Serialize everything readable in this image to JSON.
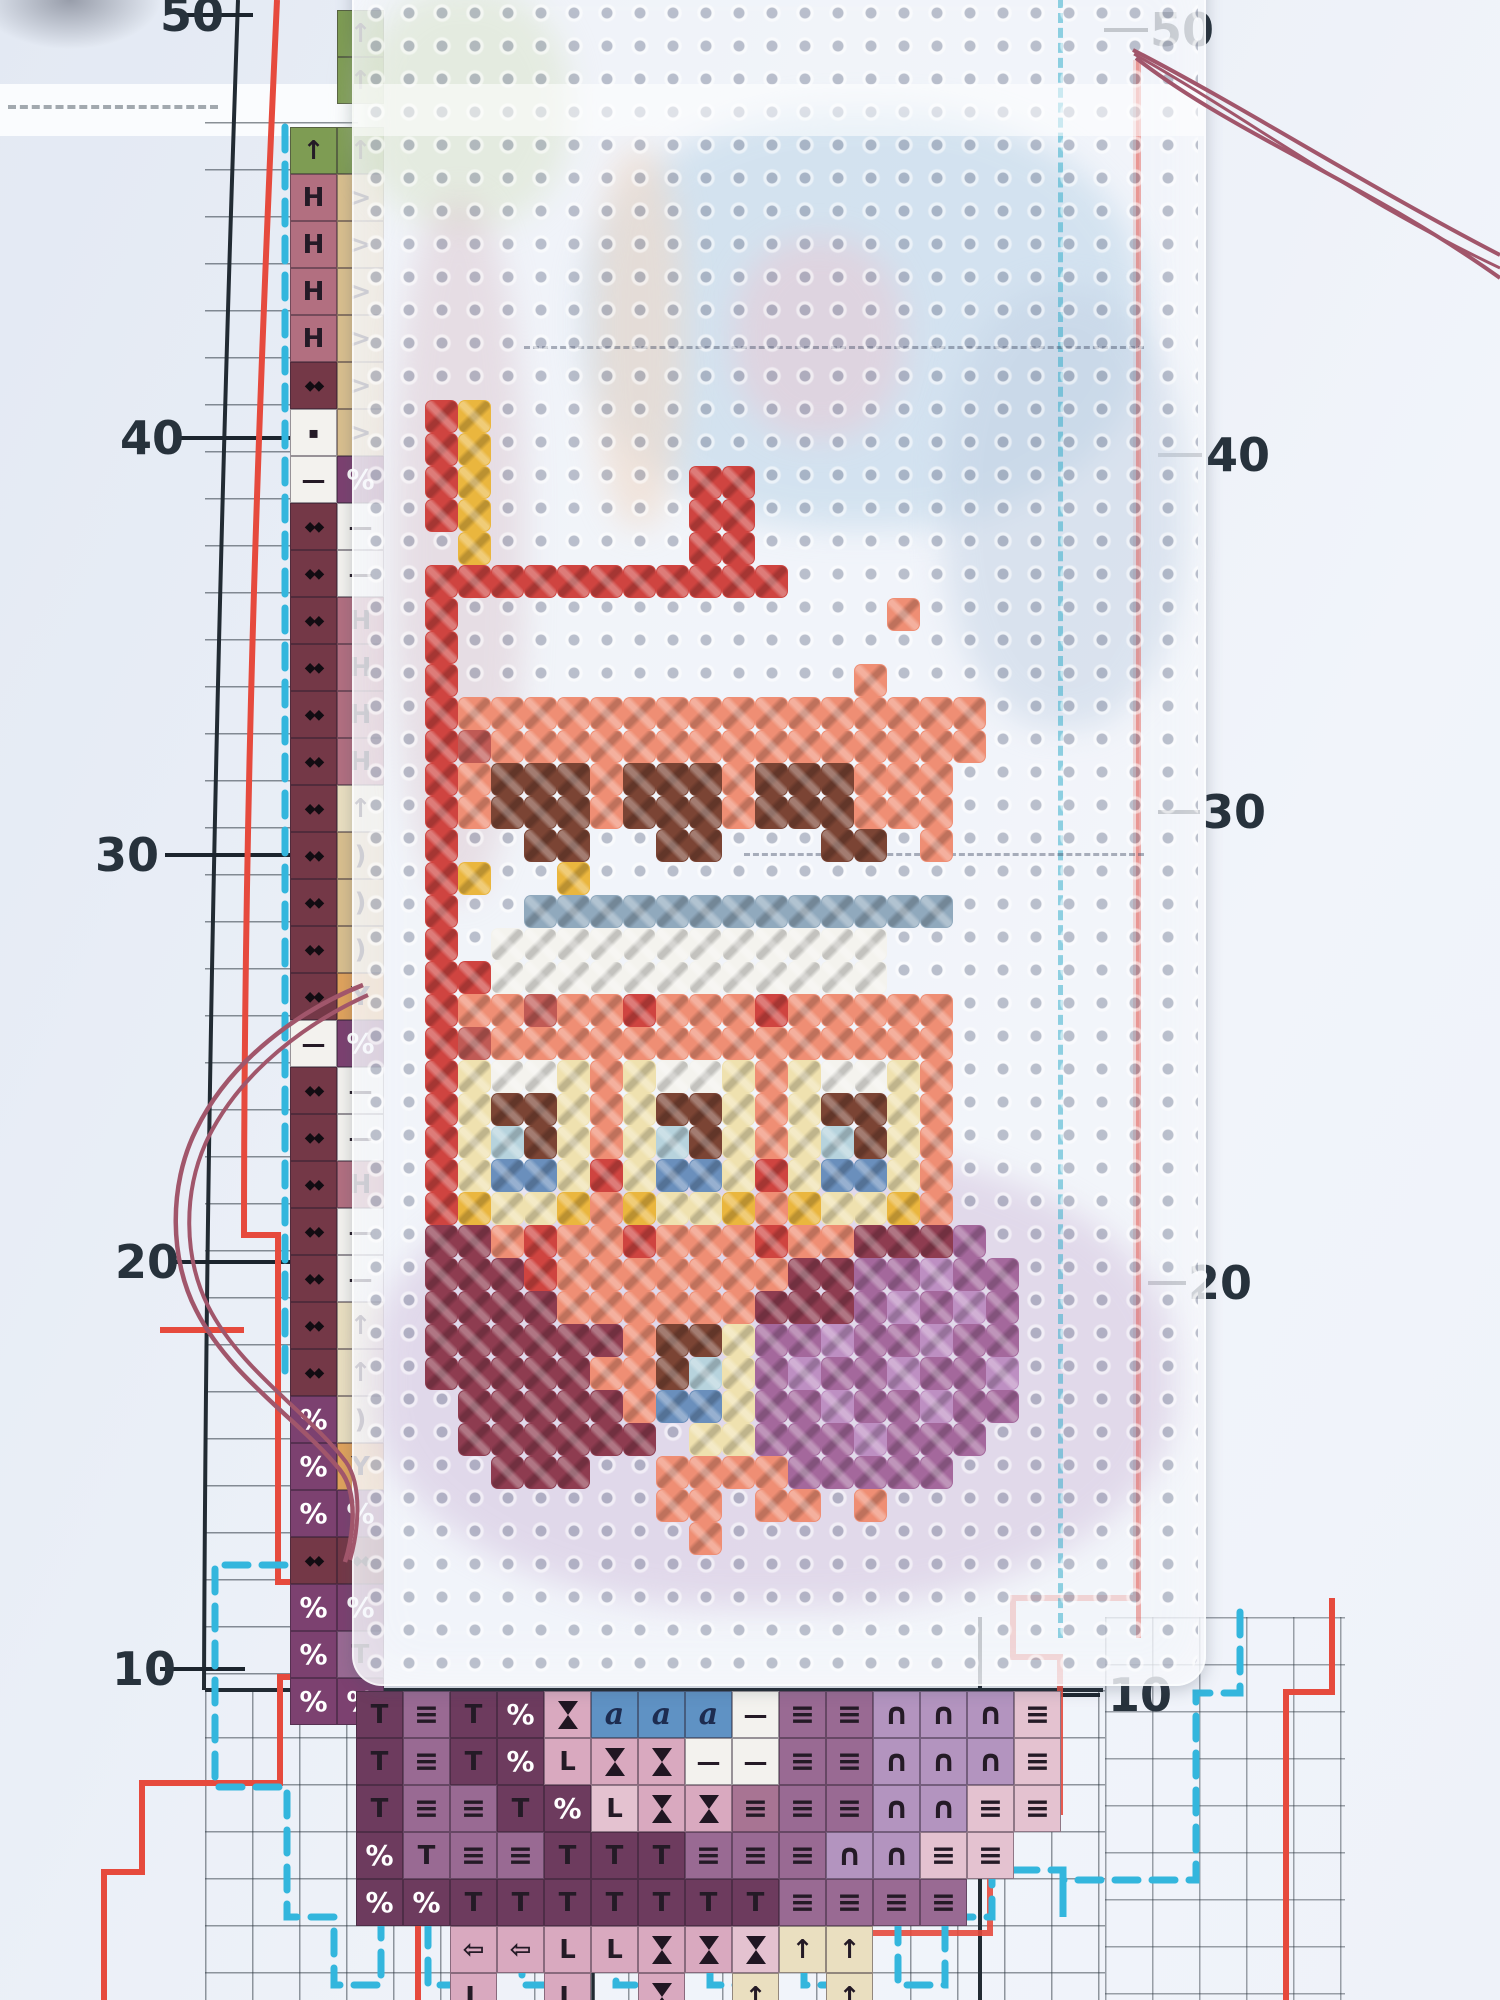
{
  "scene_type": "photo of cross-stitch embroidery in progress on perforated plastic canvas over a printed counted-stitch chart",
  "chart": {
    "row_labels": [
      {
        "value": "50",
        "left": {
          "x": 160,
          "y": 15,
          "tick": [
            180,
            253
          ]
        },
        "right": {
          "x": 1150,
          "y": 30,
          "tick": [
            1104,
            1148
          ]
        }
      },
      {
        "value": "40",
        "left": {
          "x": 120,
          "y": 438,
          "tick": [
            180,
            358
          ]
        },
        "right": {
          "x": 1206,
          "y": 455,
          "tick": [
            1158,
            1202
          ]
        }
      },
      {
        "value": "30",
        "left": {
          "x": 95,
          "y": 855,
          "tick": [
            165,
            358
          ]
        },
        "right": {
          "x": 1202,
          "y": 812,
          "tick": [
            1158,
            1200
          ]
        }
      },
      {
        "value": "20",
        "left": {
          "x": 115,
          "y": 1262,
          "tick": [
            175,
            358
          ]
        },
        "right": {
          "x": 1188,
          "y": 1283,
          "tick": [
            1148,
            1186
          ]
        }
      },
      {
        "value": "10",
        "left": {
          "x": 112,
          "y": 1669,
          "tick": [
            160,
            245
          ]
        },
        "right": {
          "x": 1108,
          "y": 1695,
          "tick": [
            1040,
            1100
          ]
        }
      }
    ],
    "glyphs": {
      "up": "↑",
      "H": "H",
      "gt": ">",
      "diam": "◆◆",
      "sq": "▪",
      "dash": "—",
      "pct": "%",
      "paren": ")",
      "yy": "Y",
      "T": "T",
      "ident": "≡",
      "cap": "∩",
      "a": "a",
      "L": "L",
      "larr": "⇦",
      "hg": ""
    },
    "cell_palette": {
      "green": "#7e9c53",
      "mauve": "#b26f80",
      "tan": "#d9bf8e",
      "maroon": "#743847",
      "white": "#f3f2ee",
      "purple": "#7c4170",
      "cream": "#eadfc0",
      "orange": "#e0a35c",
      "plumDark": "#6d3b5e",
      "plumMid": "#996a93",
      "pink": "#d9a9bf",
      "pinkLight": "#e4c2d0",
      "lavender": "#b394bf",
      "blue": "#5f92c4",
      "mauveMid": "#a87493"
    },
    "left_strip": {
      "rows": [
        [
          10,
          null,
          [
            "up",
            "green"
          ]
        ],
        [
          57,
          null,
          [
            "up",
            "green"
          ]
        ],
        [
          127,
          [
            "up",
            "green"
          ],
          [
            "up",
            "green"
          ]
        ],
        [
          174,
          [
            "H",
            "mauve"
          ],
          [
            "gt",
            "tan"
          ]
        ],
        [
          221,
          [
            "H",
            "mauve"
          ],
          [
            "gt",
            "tan"
          ]
        ],
        [
          268,
          [
            "H",
            "mauve"
          ],
          [
            "gt",
            "tan"
          ]
        ],
        [
          315,
          [
            "H",
            "mauve"
          ],
          [
            "gt",
            "tan"
          ]
        ],
        [
          362,
          [
            "diam",
            "maroon"
          ],
          [
            "gt",
            "tan"
          ]
        ],
        [
          409,
          [
            "sq",
            "white"
          ],
          [
            "gt",
            "tan"
          ]
        ],
        [
          456,
          [
            "dash",
            "white"
          ],
          [
            "pct",
            "purple"
          ]
        ],
        [
          503,
          [
            "diam",
            "maroon"
          ],
          [
            "dash",
            "white"
          ]
        ],
        [
          550,
          [
            "diam",
            "maroon"
          ],
          [
            "dash",
            "white"
          ]
        ],
        [
          597,
          [
            "diam",
            "maroon"
          ],
          [
            "H",
            "mauve"
          ]
        ],
        [
          644,
          [
            "diam",
            "maroon"
          ],
          [
            "H",
            "mauve"
          ]
        ],
        [
          691,
          [
            "diam",
            "maroon"
          ],
          [
            "H",
            "mauve"
          ]
        ],
        [
          738,
          [
            "diam",
            "maroon"
          ],
          [
            "H",
            "mauve"
          ]
        ],
        [
          785,
          [
            "diam",
            "maroon"
          ],
          [
            "up",
            "cream"
          ]
        ],
        [
          832,
          [
            "diam",
            "maroon"
          ],
          [
            "paren",
            "tan"
          ]
        ],
        [
          879,
          [
            "diam",
            "maroon"
          ],
          [
            "paren",
            "tan"
          ]
        ],
        [
          926,
          [
            "diam",
            "maroon"
          ],
          [
            "paren",
            "tan"
          ]
        ],
        [
          973,
          [
            "diam",
            "maroon"
          ],
          [
            "yy",
            "orange"
          ]
        ],
        [
          1020,
          [
            "dash",
            "white"
          ],
          [
            "pct",
            "purple"
          ]
        ],
        [
          1067,
          [
            "diam",
            "maroon"
          ],
          [
            "dash",
            "white"
          ]
        ],
        [
          1114,
          [
            "diam",
            "maroon"
          ],
          [
            "dash",
            "white"
          ]
        ],
        [
          1161,
          [
            "diam",
            "maroon"
          ],
          [
            "H",
            "mauve"
          ]
        ],
        [
          1208,
          [
            "diam",
            "maroon"
          ],
          [
            "dash",
            "white"
          ]
        ],
        [
          1255,
          [
            "diam",
            "maroon"
          ],
          [
            "dash",
            "white"
          ]
        ],
        [
          1302,
          [
            "diam",
            "maroon"
          ],
          [
            "up",
            "cream"
          ]
        ],
        [
          1349,
          [
            "diam",
            "maroon"
          ],
          [
            "up",
            "cream"
          ]
        ],
        [
          1396,
          [
            "pct",
            "purple"
          ],
          [
            "paren",
            "cream"
          ]
        ],
        [
          1443,
          [
            "pct",
            "purple"
          ],
          [
            "yy",
            "orange"
          ]
        ],
        [
          1490,
          [
            "pct",
            "purple"
          ],
          [
            "pct",
            "purple"
          ]
        ],
        [
          1537,
          [
            "diam",
            "maroon"
          ],
          [
            "diam",
            "maroon"
          ]
        ],
        [
          1584,
          [
            "pct",
            "purple"
          ],
          [
            "pct",
            "purple"
          ]
        ],
        [
          1631,
          [
            "pct",
            "purple"
          ],
          [
            "T",
            "plumMid"
          ]
        ],
        [
          1678,
          [
            "pct",
            "purple"
          ],
          [
            "pct",
            "purple"
          ]
        ]
      ]
    },
    "bottom_block": {
      "origin": [
        356,
        1691
      ],
      "rows": [
        [
          [
            "T",
            "plumDark"
          ],
          [
            "ident",
            "plumMid"
          ],
          [
            "T",
            "plumDark"
          ],
          [
            "pct",
            "plumDark"
          ],
          [
            "hg",
            "pink"
          ],
          [
            "a",
            "blue"
          ],
          [
            "a",
            "blue"
          ],
          [
            "a",
            "blue"
          ],
          [
            "dash",
            "white"
          ],
          [
            "ident",
            "plumMid"
          ],
          [
            "ident",
            "plumMid"
          ],
          [
            "cap",
            "lavender"
          ],
          [
            "cap",
            "lavender"
          ],
          [
            "cap",
            "lavender"
          ],
          [
            "ident",
            "pinkLight"
          ]
        ],
        [
          [
            "T",
            "plumDark"
          ],
          [
            "ident",
            "plumMid"
          ],
          [
            "T",
            "plumDark"
          ],
          [
            "pct",
            "plumDark"
          ],
          [
            "L",
            "pink"
          ],
          [
            "hg",
            "pink"
          ],
          [
            "hg",
            "pink"
          ],
          [
            "dash",
            "white"
          ],
          [
            "dash",
            "white"
          ],
          [
            "ident",
            "plumMid"
          ],
          [
            "ident",
            "plumMid"
          ],
          [
            "cap",
            "lavender"
          ],
          [
            "cap",
            "lavender"
          ],
          [
            "cap",
            "lavender"
          ],
          [
            "ident",
            "pinkLight"
          ]
        ],
        [
          [
            "T",
            "plumDark"
          ],
          [
            "ident",
            "plumMid"
          ],
          [
            "ident",
            "plumMid"
          ],
          [
            "T",
            "plumDark"
          ],
          [
            "pct",
            "plumDark"
          ],
          [
            "L",
            "pinkLight"
          ],
          [
            "hg",
            "pink"
          ],
          [
            "hg",
            "pink"
          ],
          [
            "ident",
            "mauveMid"
          ],
          [
            "ident",
            "plumMid"
          ],
          [
            "ident",
            "plumMid"
          ],
          [
            "cap",
            "lavender"
          ],
          [
            "cap",
            "lavender"
          ],
          [
            "ident",
            "pinkLight"
          ],
          [
            "ident",
            "pinkLight"
          ]
        ],
        [
          [
            "pct",
            "plumDark"
          ],
          [
            "T",
            "plumMid"
          ],
          [
            "ident",
            "plumMid"
          ],
          [
            "ident",
            "plumMid"
          ],
          [
            "T",
            "plumDark"
          ],
          [
            "T",
            "plumDark"
          ],
          [
            "T",
            "plumDark"
          ],
          [
            "ident",
            "plumMid"
          ],
          [
            "ident",
            "plumMid"
          ],
          [
            "ident",
            "plumMid"
          ],
          [
            "cap",
            "lavender"
          ],
          [
            "cap",
            "lavender"
          ],
          [
            "ident",
            "pinkLight"
          ],
          [
            "ident",
            "pinkLight"
          ],
          null
        ],
        [
          [
            "pct",
            "plumDark"
          ],
          [
            "pct",
            "plumDark"
          ],
          [
            "T",
            "plumDark"
          ],
          [
            "T",
            "plumDark"
          ],
          [
            "T",
            "plumDark"
          ],
          [
            "T",
            "plumDark"
          ],
          [
            "T",
            "plumDark"
          ],
          [
            "T",
            "plumDark"
          ],
          [
            "T",
            "plumDark"
          ],
          [
            "ident",
            "plumMid"
          ],
          [
            "ident",
            "plumMid"
          ],
          [
            "ident",
            "plumMid"
          ],
          [
            "ident",
            "plumMid"
          ],
          null,
          null
        ],
        [
          null,
          null,
          [
            "larr",
            "pink"
          ],
          [
            "larr",
            "pink"
          ],
          [
            "L",
            "pink"
          ],
          [
            "L",
            "pink"
          ],
          [
            "hg",
            "pink"
          ],
          [
            "hg",
            "pink"
          ],
          [
            "hg",
            "pinkLight"
          ],
          [
            "up",
            "cream"
          ],
          [
            "up",
            "cream"
          ],
          null,
          null,
          null,
          null
        ],
        [
          null,
          null,
          [
            "L",
            "pink"
          ],
          null,
          [
            "L",
            "pink"
          ],
          null,
          [
            "hg",
            "pink"
          ],
          null,
          [
            "up",
            "cream"
          ],
          null,
          [
            "up",
            "cream"
          ],
          null,
          null,
          null,
          null
        ]
      ]
    },
    "line_colors": {
      "cut_line_red": "#e64a3d",
      "stitch_outline_blue": "#33b6dd",
      "grid_black": "#222b33"
    }
  },
  "canvas": {
    "stitch_palette": {
      "R": "#cf4440",
      "S": "#ef8e74",
      "D": "#c05a55",
      "M": "#8e3c50",
      "P": "#a4689c",
      "L": "#bd8fc2",
      "Y": "#eab63e",
      "C": "#efe1af",
      "W": "#f4f3ee",
      "B": "#7b4434",
      "U": "#6a8fbc",
      "T": "#b7d3dd",
      "G": "#90a9bd"
    },
    "motif_origin": [
      425,
      400
    ],
    "motif_rows": [
      "RY..................",
      "RY..................",
      "RY......RR..........",
      "RY......RR..........",
      ".Y......RR..........",
      "RRRRRRRRRRR.........",
      "R.............S.....",
      "R...................",
      "R............S......",
      "RSSSSSSSSSSSSSSSS...",
      "RDSSSSSSSSSSSSSSS...",
      "RSBBBSBBBSBBBSSS....",
      "RSBBBSBBBSBBBSSS....",
      "R..BB..BB...BB.S....",
      "RY..Y...............",
      "R..GGGGGGGGGGGGG....",
      "R.WWWWWWWWWWWW......",
      "RRWWWWWWWWWWWW......",
      "RSSDSSRSSSRSSSSS....",
      "RDSSSSSSSSSSSSSS....",
      "RCWWCSCWWCSCWWCS....",
      "RCBBCSCBBCSCBBCS....",
      "RCTBCSCTBCSCTBCS....",
      "RCUUCRCUUCRCUUCS....",
      "RYCCYSYCCYSYCCYS....",
      "MMSRSSRSSSRSSMMMP...",
      "MMMRSSSSSSSMMPPLPP..",
      "MMMMSSSSSSMMMPLPLP..",
      "MMMMMMSBBCPPLPPLPP..",
      "MMMMMSSBTCPLPPLPPL..",
      ".MMMMMSUUCPPLPPLPP..",
      ".MMMMMM.CCPPPLPPP...",
      "..MMM..SSSSPPPPP....",
      ".......SS.SS.S......",
      "........S..........."
    ]
  },
  "threads": {
    "color": "#a1566b",
    "shadow": "#7e3f4f"
  }
}
